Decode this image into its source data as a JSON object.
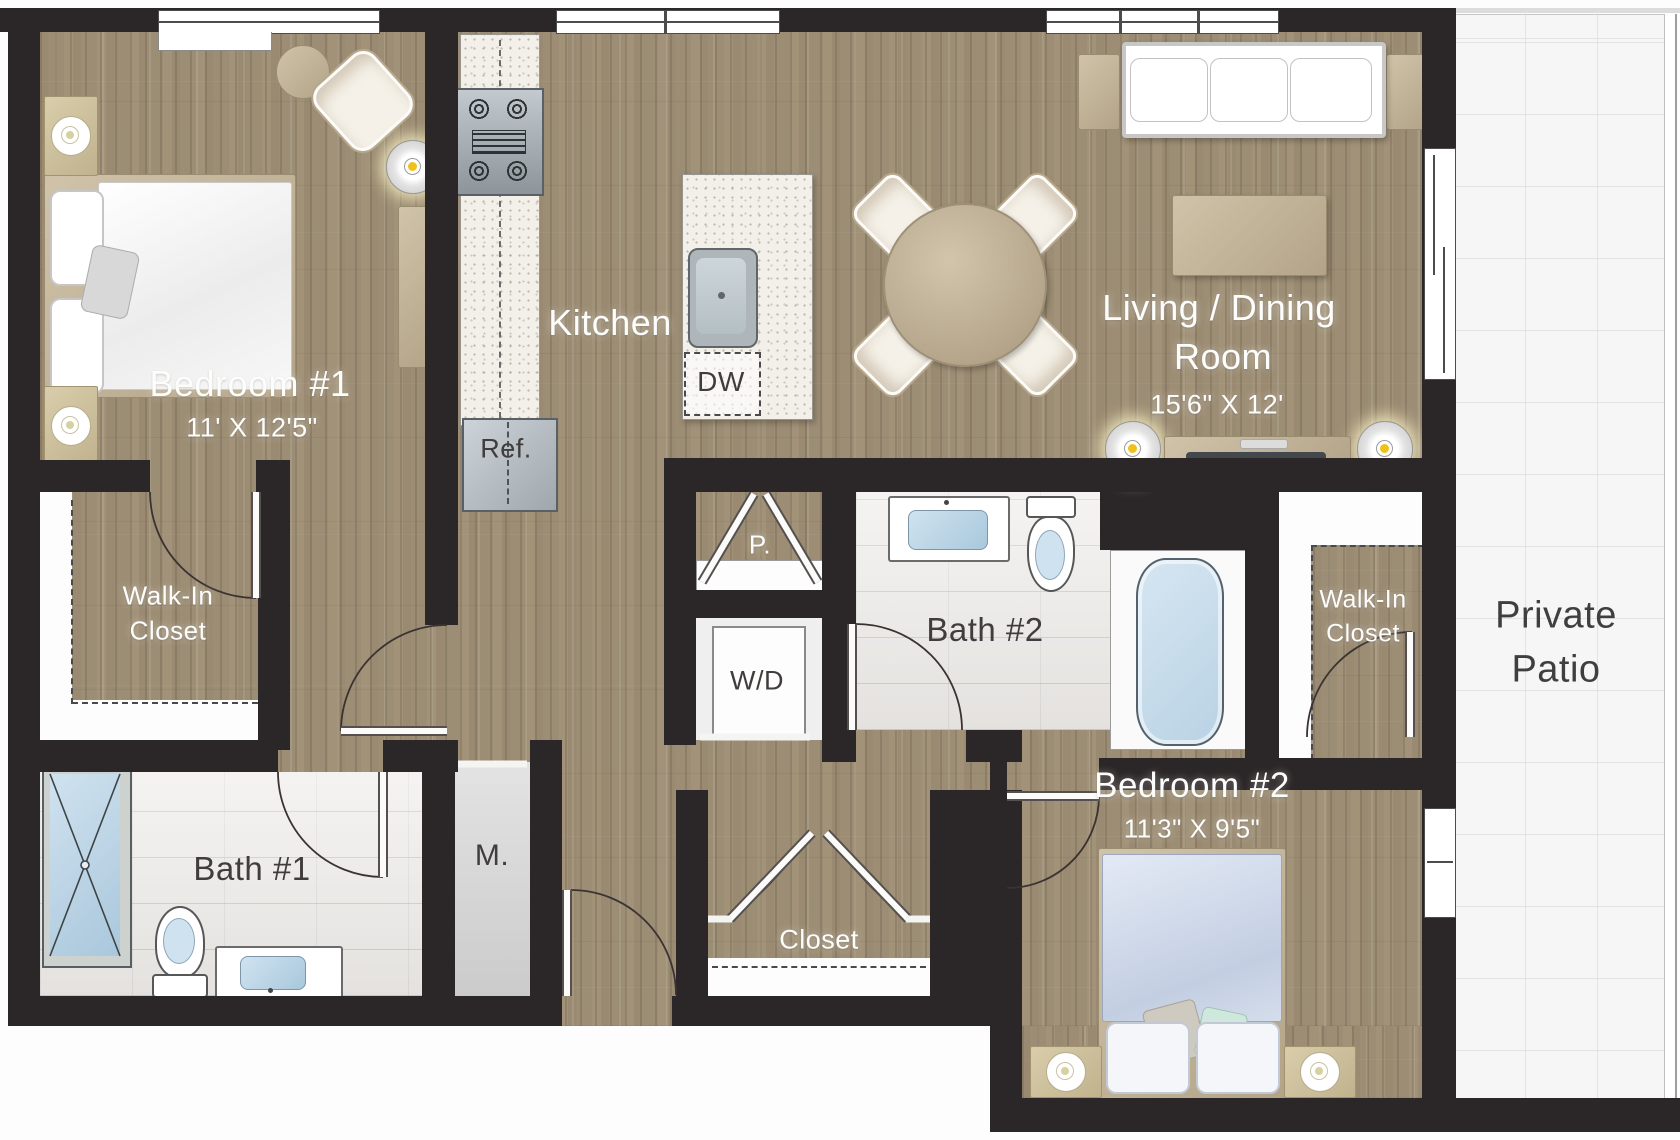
{
  "floor_plan": {
    "rooms": {
      "bedroom_1": {
        "label": "Bedroom #1",
        "dimensions": "11' X 12'5\""
      },
      "kitchen": {
        "label": "Kitchen"
      },
      "living_dining": {
        "line_1": "Living / Dining",
        "line_2": "Room",
        "dimensions": "15'6\" X 12'"
      },
      "bedroom_2": {
        "label": "Bedroom #2",
        "dimensions": "11'3\" X 9'5\""
      },
      "bath_1": {
        "label": "Bath #1"
      },
      "bath_2": {
        "label": "Bath #2"
      },
      "walk_in_closet_left": {
        "line_1": "Walk-In",
        "line_2": "Closet"
      },
      "walk_in_closet_right": {
        "line_1": "Walk-In",
        "line_2": "Closet"
      },
      "closet": {
        "label": "Closet"
      },
      "private_patio": {
        "line_1": "Private",
        "line_2": "Patio"
      },
      "pantry": {
        "label": "P."
      },
      "mechanical": {
        "label": "M."
      },
      "washer_dryer": {
        "label": "W/D"
      },
      "dishwasher": {
        "label": "DW"
      },
      "refrigerator": {
        "label": "Ref."
      }
    },
    "colors": {
      "wall": "#2b2627",
      "wood_floor": "#a29379",
      "bath_tile": "#eceae7",
      "patio_tile": "#f6f6f7",
      "fixture_blue": "#c3d9ea",
      "lamp_yellow": "#f0c11a",
      "label_light": "#fdfdfc",
      "label_dark": "#413d3c"
    }
  }
}
